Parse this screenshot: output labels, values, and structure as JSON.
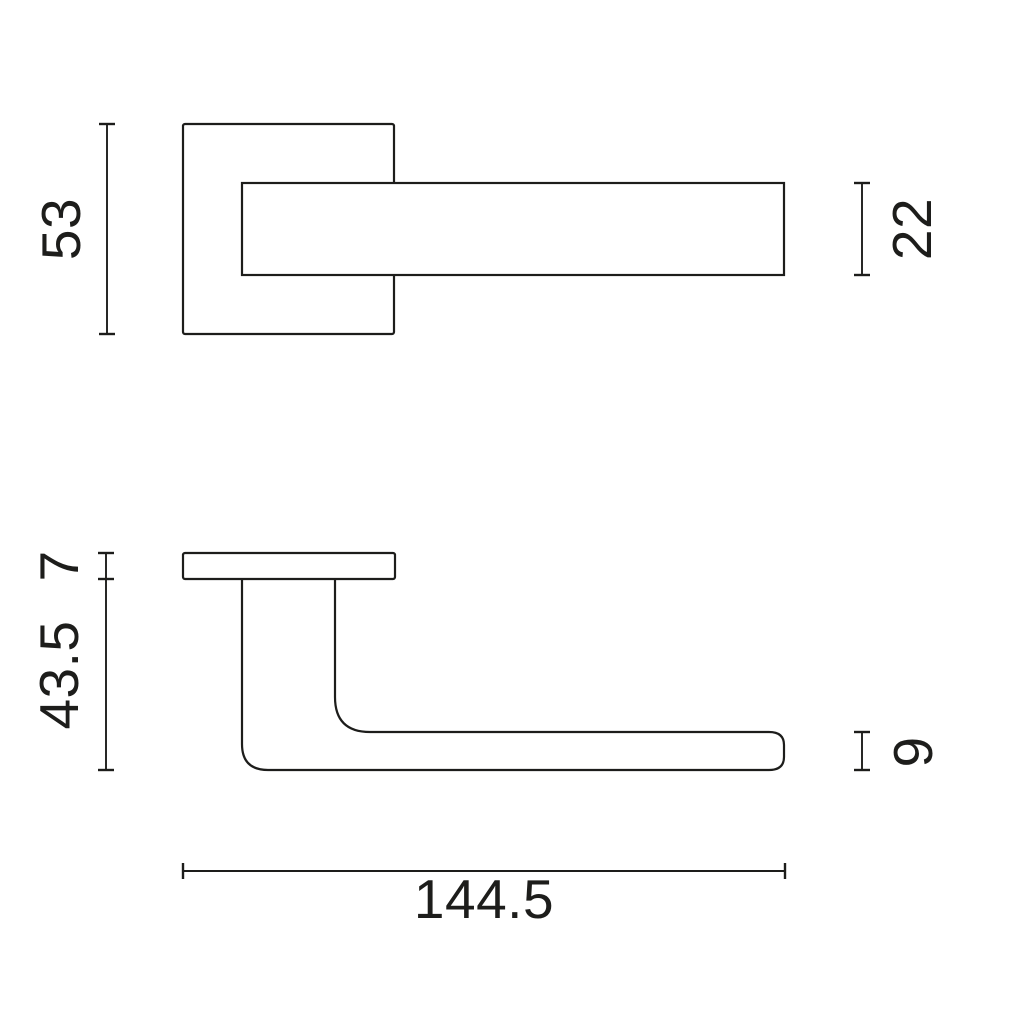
{
  "drawing": {
    "type": "technical-dimension-drawing",
    "subject": "door-lever-handle-on-square-rose",
    "views": {
      "front_view": "handle front view with square rose and lever bar",
      "side_view": "handle side profile with rose plate, neck and lever"
    }
  },
  "dimensions": {
    "rose_size": "53",
    "lever_section_height": "22",
    "rose_thickness": "7",
    "handle_projection": "43.5",
    "lever_thickness": "9",
    "overall_length": "144.5"
  },
  "colors": {
    "line": "#1d1d1b",
    "background": "#ffffff"
  }
}
